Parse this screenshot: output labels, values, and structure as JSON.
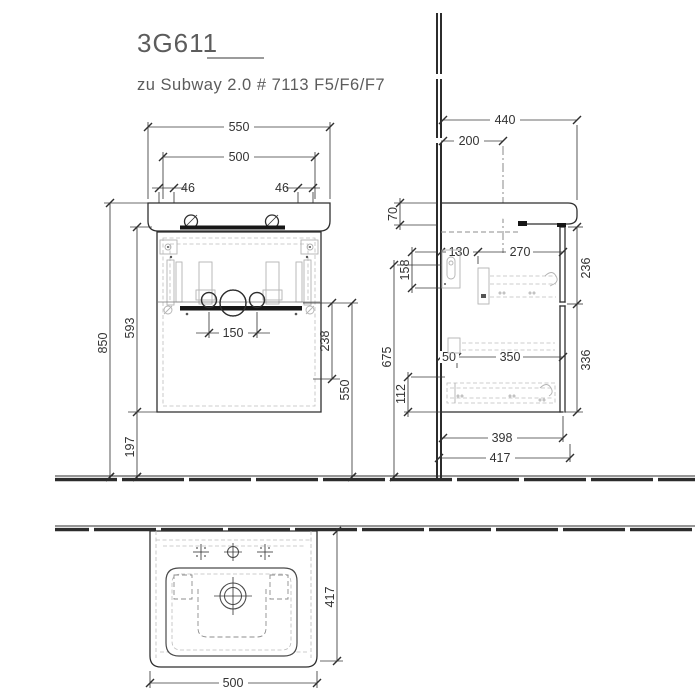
{
  "drawing": {
    "model": "3G611",
    "series_note": "zu Subway 2.0 # 7113 F5/F6/F7",
    "front": {
      "basin_width": "550",
      "cabinet_width": "500",
      "offset_left": "46",
      "offset_right": "46",
      "total_height": "850",
      "cabinet_height": "593",
      "floor_clearance": "197",
      "drain_spacing": "150",
      "drawer_inner_height": "238",
      "drain_height": "550"
    },
    "side": {
      "basin_depth": "440",
      "tap_center": "200",
      "apron_height": "70",
      "bracket_height": "158",
      "back_offset": "130",
      "rail_length": "270",
      "upper_front_height": "236",
      "outlet_height": "675",
      "front_gap": "50",
      "lower_rail_length": "350",
      "lower_front_height": "336",
      "bottom_inner": "112",
      "cabinet_depth": "398",
      "overall_depth": "417"
    },
    "plan": {
      "cabinet_width": "500",
      "cabinet_depth": "417"
    }
  }
}
